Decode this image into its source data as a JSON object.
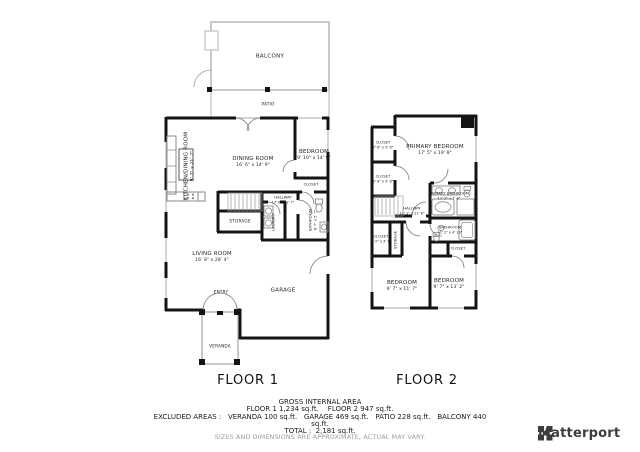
{
  "floor1": {
    "title": "FLOOR 1",
    "labels": {
      "balcony": "BALCONY",
      "patio": "PATIO",
      "storage": "STORAGE",
      "laundry": "LAUNDRY",
      "entry": "ENTRY",
      "garage": "GARAGE",
      "veranda": "VERANDA",
      "closet": "CLOSET"
    },
    "rooms": {
      "kitchen": {
        "name": "KITCHEN/DINING ROOM",
        "dims": "9' 7\" x 21' 7\""
      },
      "dining": {
        "name": "DINING ROOM",
        "dims": "16' 6\" x 14' 9\""
      },
      "bedroom": {
        "name": "BEDROOM",
        "dims": "9' 10\" x 14' 9\""
      },
      "hallway": {
        "name": "HALLWAY",
        "dims": "17' 6\" x 3' 7\""
      },
      "bathroom": {
        "name": "BATHROOM",
        "dims": "8' 7\" x 5' 7\""
      },
      "living": {
        "name": "LIVING ROOM",
        "dims": "16' 8\" x 28' 4\""
      }
    }
  },
  "floor2": {
    "title": "FLOOR 2",
    "labels": {
      "storage": "STORAGE",
      "closet": "CLOSET"
    },
    "rooms": {
      "primary_bedroom": {
        "name": "PRIMARY BEDROOM",
        "dims": "17' 5\" x 19' 8\""
      },
      "closet_a": {
        "name": "CLOSET",
        "dims": "7' 8\" x 3' 6\""
      },
      "closet_b": {
        "name": "CLOSET",
        "dims": "5' 8\" x 3' 8\""
      },
      "hallway": {
        "name": "HALLWAY",
        "dims": "12' 1\" x 11' 8\""
      },
      "primary_bathroom": {
        "name": "PRIMARY BATHROOM",
        "dims": "11' 2\" x 7' 8\""
      },
      "bathroom": {
        "name": "BATHROOM",
        "dims": "11' 2\" x 4' 10\""
      },
      "closet_d": {
        "name": "CLOSET",
        "dims": "4' 2\" x 3' 6\""
      },
      "bedroom_left": {
        "name": "BEDROOM",
        "dims": "9' 7\" x 11' 7\""
      },
      "bedroom_right": {
        "name": "BEDROOM",
        "dims": "9' 7\" x 13' 2\""
      }
    }
  },
  "footer": {
    "title": "GROSS INTERNAL AREA",
    "line_floors": "FLOOR 1 1,234 sq.ft.    FLOOR 2 947 sq.ft.",
    "line_excluded": "EXCLUDED AREAS :   VERANDA 100 sq.ft.   GARAGE 469 sq.ft.   PATIO 228 sq.ft.   BALCONY 440",
    "line_excluded2": "sq.ft.",
    "line_total": "TOTAL :  2,181 sq.ft.",
    "disclaimer": "SIZES AND DIMENSIONS ARE APPROXIMATE, ACTUAL MAY VARY."
  },
  "brand": {
    "name": "Matterport"
  },
  "colors": {
    "wall": "#141414",
    "light_outline": "#c9c9c9",
    "fixture": "#8a8a8a",
    "stair": "#b5b5b5",
    "disclaimer": "#9b9b9b",
    "brand": "#3d3d3d"
  }
}
